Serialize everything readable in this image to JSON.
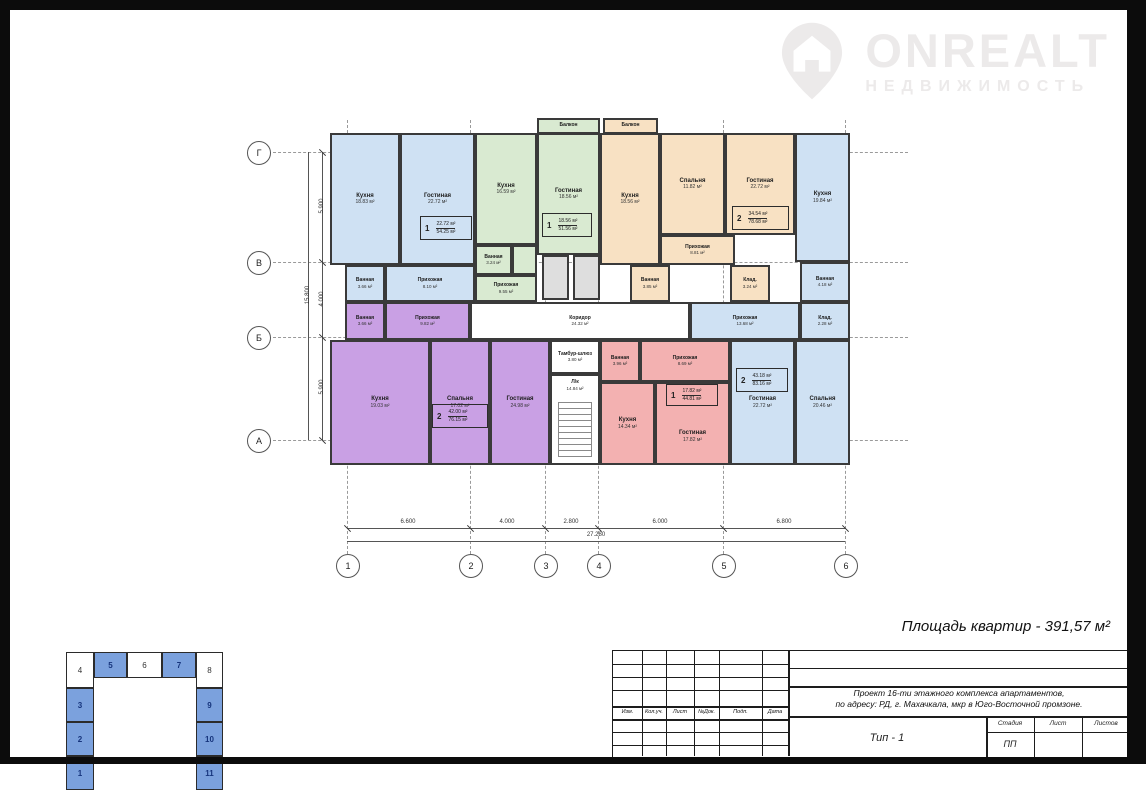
{
  "logo": {
    "word": "ONREALT",
    "subtitle": "НЕДВИЖИМОСТЬ"
  },
  "summary": {
    "text": "Площадь квартир - 391,57 м²"
  },
  "colors": {
    "apartment_blue": "#cfe1f3",
    "apartment_green": "#d9ead1",
    "apartment_orange": "#f8e1c3",
    "apartment_purple": "#c9a0e4",
    "apartment_red": "#f3b1b1",
    "site_block_blue": "#7ba1dd"
  },
  "axes": {
    "rows": [
      "Г",
      "В",
      "Б",
      "А"
    ],
    "cols": [
      "1",
      "2",
      "3",
      "4",
      "5",
      "6"
    ]
  },
  "dims": {
    "left": {
      "segments": [
        "5.900",
        "4.000",
        "5.900"
      ],
      "total": "15.800"
    },
    "bottom": {
      "segments": [
        "6.600",
        "4.000",
        "2.800",
        "6.000",
        "6.800"
      ],
      "total": "27.280"
    }
  },
  "plan": {
    "apartments": [
      {
        "id": "apt-1-left-blue",
        "badge": {
          "num": "1",
          "area1": "22.72 м²",
          "area2": "54.25 м²"
        },
        "rooms": [
          {
            "label": "Кухня",
            "area": "18.83 м²"
          },
          {
            "label": "Гостиная",
            "area": "22.72 м²"
          },
          {
            "label": "Ванная",
            "area": "3.66 м²"
          },
          {
            "label": "Прихожая",
            "area": "8.10 м²"
          }
        ]
      },
      {
        "id": "apt-2-green",
        "badge": {
          "num": "1",
          "area1": "18.56 м²",
          "area2": "51.56 м²"
        },
        "rooms": [
          {
            "label": "Балкон",
            "area": "3.69 м²"
          },
          {
            "label": "Кухня",
            "area": "16.59 м²"
          },
          {
            "label": "Гостиная",
            "area": "18.56 м²"
          },
          {
            "label": "Ванная",
            "area": "3.24 м²"
          },
          {
            "label": "Прихожая",
            "area": "9.55 м²"
          }
        ]
      },
      {
        "id": "apt-3-orange",
        "badge": {
          "num": "2",
          "area1": "34.54 м²",
          "area2": "78.68 м²"
        },
        "rooms": [
          {
            "label": "Балкон",
            "area": "3.66 м²"
          },
          {
            "label": "Кухня",
            "area": "18.56 м²"
          },
          {
            "label": "Спальня",
            "area": "11.82 м²"
          },
          {
            "label": "Гостиная",
            "area": "22.72 м²"
          },
          {
            "label": "Прихожая",
            "area": "8.81 м²"
          },
          {
            "label": "Ванная",
            "area": "3.85 м²"
          },
          {
            "label": "Клад.",
            "area": "3.24 м²"
          }
        ]
      },
      {
        "id": "apt-4-right-blue",
        "badge": {
          "num": "2",
          "area1": "43.18 м²",
          "area2": "83.16 м²"
        },
        "rooms": [
          {
            "label": "Кухня",
            "area": "19.84 м²"
          },
          {
            "label": "Ванная",
            "area": "4.18 м²"
          },
          {
            "label": "Прихожая",
            "area": "13.68 м²"
          },
          {
            "label": "Клад.",
            "area": "2.28 м²"
          },
          {
            "label": "Гостиная",
            "area": "22.72 м²"
          },
          {
            "label": "Спальня",
            "area": "20.46 м²"
          }
        ]
      },
      {
        "id": "apt-5-purple",
        "badge": {
          "num": "2",
          "area1": "42.00 м²",
          "area2": "76.15 м²"
        },
        "rooms": [
          {
            "label": "Ванная",
            "area": "3.66 м²"
          },
          {
            "label": "Прихожая",
            "area": "9.82 м²"
          },
          {
            "label": "Кухня",
            "area": "19.03 м²"
          },
          {
            "label": "Спальня",
            "area": "17.02 м²"
          },
          {
            "label": "Гостиная",
            "area": "24.98 м²"
          }
        ]
      },
      {
        "id": "apt-6-red",
        "badge": {
          "num": "1",
          "area1": "17.82 м²",
          "area2": "44.81 м²"
        },
        "rooms": [
          {
            "label": "Ванная",
            "area": "3.96 м²"
          },
          {
            "label": "Прихожая",
            "area": "8.69 м²"
          },
          {
            "label": "Кухня",
            "area": "14.34 м²"
          },
          {
            "label": "Гостиная",
            "area": "17.82 м²"
          }
        ]
      }
    ],
    "common": [
      {
        "label": "Коридор",
        "area": "24.32 м²"
      },
      {
        "label": "Тамбур-шлюз",
        "area": "3.80 м²"
      },
      {
        "label": "Л/к",
        "area": "14.84 м²"
      }
    ]
  },
  "titleblock": {
    "revision_headers": [
      "Изм.",
      "Кол.уч.",
      "Лист",
      "№Док.",
      "Подп.",
      "Дата"
    ],
    "project_line1": "Проект 16-ти этажного комплекса апартаментов,",
    "project_line2": "по адресу: РД, г. Махачкала, мкр в Юго-Восточной промзоне.",
    "type_label": "Тип - 1",
    "stage_headers": [
      "Стадия",
      "Лист",
      "Листов"
    ],
    "stage_value": "ПП"
  },
  "siteplan": {
    "cells": [
      "4",
      "5",
      "6",
      "7",
      "8",
      "3",
      "2",
      "1",
      "9",
      "10",
      "11"
    ]
  }
}
